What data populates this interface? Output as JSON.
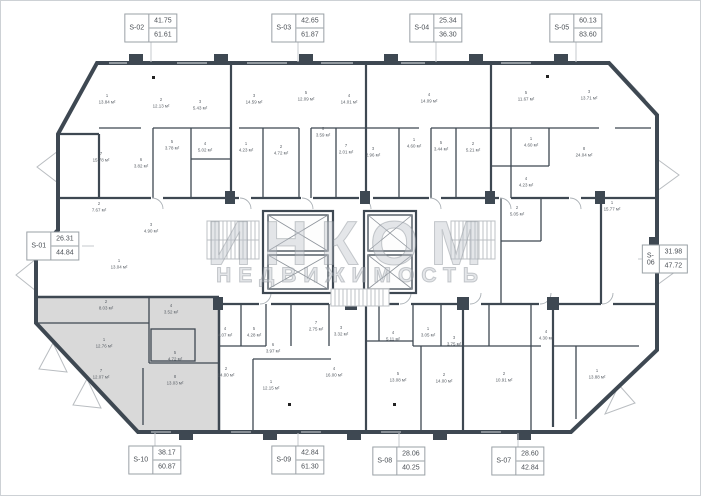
{
  "page": {
    "background": "#ffffff",
    "border_color": "#cdd1d5"
  },
  "watermark": {
    "line1": "ИНКОМ",
    "line2": "НЕДВИЖИМОСТЬ",
    "color": "#9aa0a8"
  },
  "colors": {
    "wall": "#3e4852",
    "highlight_fill": "#d9d9d9",
    "light_line": "#b9bdc1",
    "label_text": "#565c63"
  },
  "highlighted_unit": "S-10",
  "units": [
    {
      "id": "S-01",
      "area1": "26.31",
      "area2": "44.84",
      "x": 52,
      "y": 245
    },
    {
      "id": "S-02",
      "area1": "41.75",
      "area2": "61.61",
      "x": 150,
      "y": 27
    },
    {
      "id": "S-03",
      "area1": "42.65",
      "area2": "61.87",
      "x": 297,
      "y": 27
    },
    {
      "id": "S-04",
      "area1": "25.34",
      "area2": "36.30",
      "x": 435,
      "y": 27
    },
    {
      "id": "S-05",
      "area1": "60.13",
      "area2": "83.60",
      "x": 575,
      "y": 27
    },
    {
      "id": "S-06",
      "area1": "31.98",
      "area2": "47.72",
      "x": 664,
      "y": 258
    },
    {
      "id": "S-10",
      "area1": "38.17",
      "area2": "60.87",
      "x": 154,
      "y": 459
    },
    {
      "id": "S-09",
      "area1": "42.84",
      "area2": "61.30",
      "x": 297,
      "y": 459
    },
    {
      "id": "S-08",
      "area1": "28.06",
      "area2": "40.25",
      "x": 398,
      "y": 460
    },
    {
      "id": "S-07",
      "area1": "28.60",
      "area2": "42.84",
      "x": 517,
      "y": 460
    }
  ],
  "rooms": [
    {
      "n": "2",
      "a": "7.67 м²",
      "x": 98,
      "y": 207
    },
    {
      "n": "1",
      "a": "13.04 м²",
      "x": 118,
      "y": 264
    },
    {
      "n": "3",
      "a": "4.90 м²",
      "x": 150,
      "y": 228
    },
    {
      "n": "1",
      "a": "13.84 м²",
      "x": 106,
      "y": 99
    },
    {
      "n": "2",
      "a": "12.13 м²",
      "x": 160,
      "y": 103
    },
    {
      "n": "3",
      "a": "5.43 м²",
      "x": 199,
      "y": 105
    },
    {
      "n": "5",
      "a": "3.78 м²",
      "x": 171,
      "y": 145
    },
    {
      "n": "4",
      "a": "5.02 м²",
      "x": 204,
      "y": 147
    },
    {
      "n": "6",
      "a": "3.82 м²",
      "x": 140,
      "y": 163
    },
    {
      "n": "7",
      "a": "15.78 м²",
      "x": 100,
      "y": 157
    },
    {
      "n": "3",
      "a": "14.59 м²",
      "x": 253,
      "y": 99
    },
    {
      "n": "5",
      "a": "12.09 м²",
      "x": 305,
      "y": 96
    },
    {
      "n": "4",
      "a": "14.01 м²",
      "x": 348,
      "y": 99
    },
    {
      "n": "6",
      "a": "3.59 м²",
      "x": 322,
      "y": 132
    },
    {
      "n": "1",
      "a": "4.23 м²",
      "x": 245,
      "y": 147
    },
    {
      "n": "2",
      "a": "4.72 м²",
      "x": 280,
      "y": 150
    },
    {
      "n": "7",
      "a": "2.01 м²",
      "x": 345,
      "y": 149
    },
    {
      "n": "3",
      "a": "2.96 м²",
      "x": 372,
      "y": 152
    },
    {
      "n": "1",
      "a": "4.60 м²",
      "x": 413,
      "y": 143
    },
    {
      "n": "5",
      "a": "3.44 м²",
      "x": 440,
      "y": 146
    },
    {
      "n": "2",
      "a": "5.21 м²",
      "x": 472,
      "y": 147
    },
    {
      "n": "4",
      "a": "14.09 м²",
      "x": 428,
      "y": 98
    },
    {
      "n": "5",
      "a": "11.67 м²",
      "x": 525,
      "y": 96
    },
    {
      "n": "3",
      "a": "13.71 м²",
      "x": 588,
      "y": 95
    },
    {
      "n": "1",
      "a": "4.60 м²",
      "x": 530,
      "y": 142
    },
    {
      "n": "8",
      "a": "24.04 м²",
      "x": 583,
      "y": 152
    },
    {
      "n": "4",
      "a": "4.23 м²",
      "x": 525,
      "y": 182
    },
    {
      "n": "2",
      "a": "5.05 м²",
      "x": 516,
      "y": 211
    },
    {
      "n": "1",
      "a": "15.77 м²",
      "x": 611,
      "y": 206
    },
    {
      "n": "2",
      "a": "8.03 м²",
      "x": 105,
      "y": 305
    },
    {
      "n": "4",
      "a": "3.52 м²",
      "x": 170,
      "y": 309
    },
    {
      "n": "1",
      "a": "12.76 м²",
      "x": 103,
      "y": 343
    },
    {
      "n": "5",
      "a": "4.72 м²",
      "x": 174,
      "y": 356
    },
    {
      "n": "7",
      "a": "12.07 м²",
      "x": 100,
      "y": 374
    },
    {
      "n": "8",
      "a": "13.03 м²",
      "x": 174,
      "y": 380
    },
    {
      "n": "4",
      "a": "4.07 м²",
      "x": 224,
      "y": 332
    },
    {
      "n": "5",
      "a": "4.28 м²",
      "x": 253,
      "y": 332
    },
    {
      "n": "6",
      "a": "3.97 м²",
      "x": 272,
      "y": 348
    },
    {
      "n": "7",
      "a": "2.75 м²",
      "x": 315,
      "y": 326
    },
    {
      "n": "3",
      "a": "3.32 м²",
      "x": 340,
      "y": 331
    },
    {
      "n": "2",
      "a": "14.00 м²",
      "x": 225,
      "y": 372
    },
    {
      "n": "1",
      "a": "12.15 м²",
      "x": 270,
      "y": 385
    },
    {
      "n": "4",
      "a": "16.00 м²",
      "x": 333,
      "y": 372
    },
    {
      "n": "4",
      "a": "5.11 м²",
      "x": 392,
      "y": 336
    },
    {
      "n": "1",
      "a": "3.05 м²",
      "x": 427,
      "y": 332
    },
    {
      "n": "3",
      "a": "3.75 м²",
      "x": 453,
      "y": 341
    },
    {
      "n": "5",
      "a": "13.08 м²",
      "x": 397,
      "y": 377
    },
    {
      "n": "2",
      "a": "14.00 м²",
      "x": 443,
      "y": 378
    },
    {
      "n": "4",
      "a": "4.30 м²",
      "x": 545,
      "y": 335
    },
    {
      "n": "2",
      "a": "10.91 м²",
      "x": 503,
      "y": 377
    },
    {
      "n": "1",
      "a": "13.88 м²",
      "x": 596,
      "y": 374
    }
  ]
}
